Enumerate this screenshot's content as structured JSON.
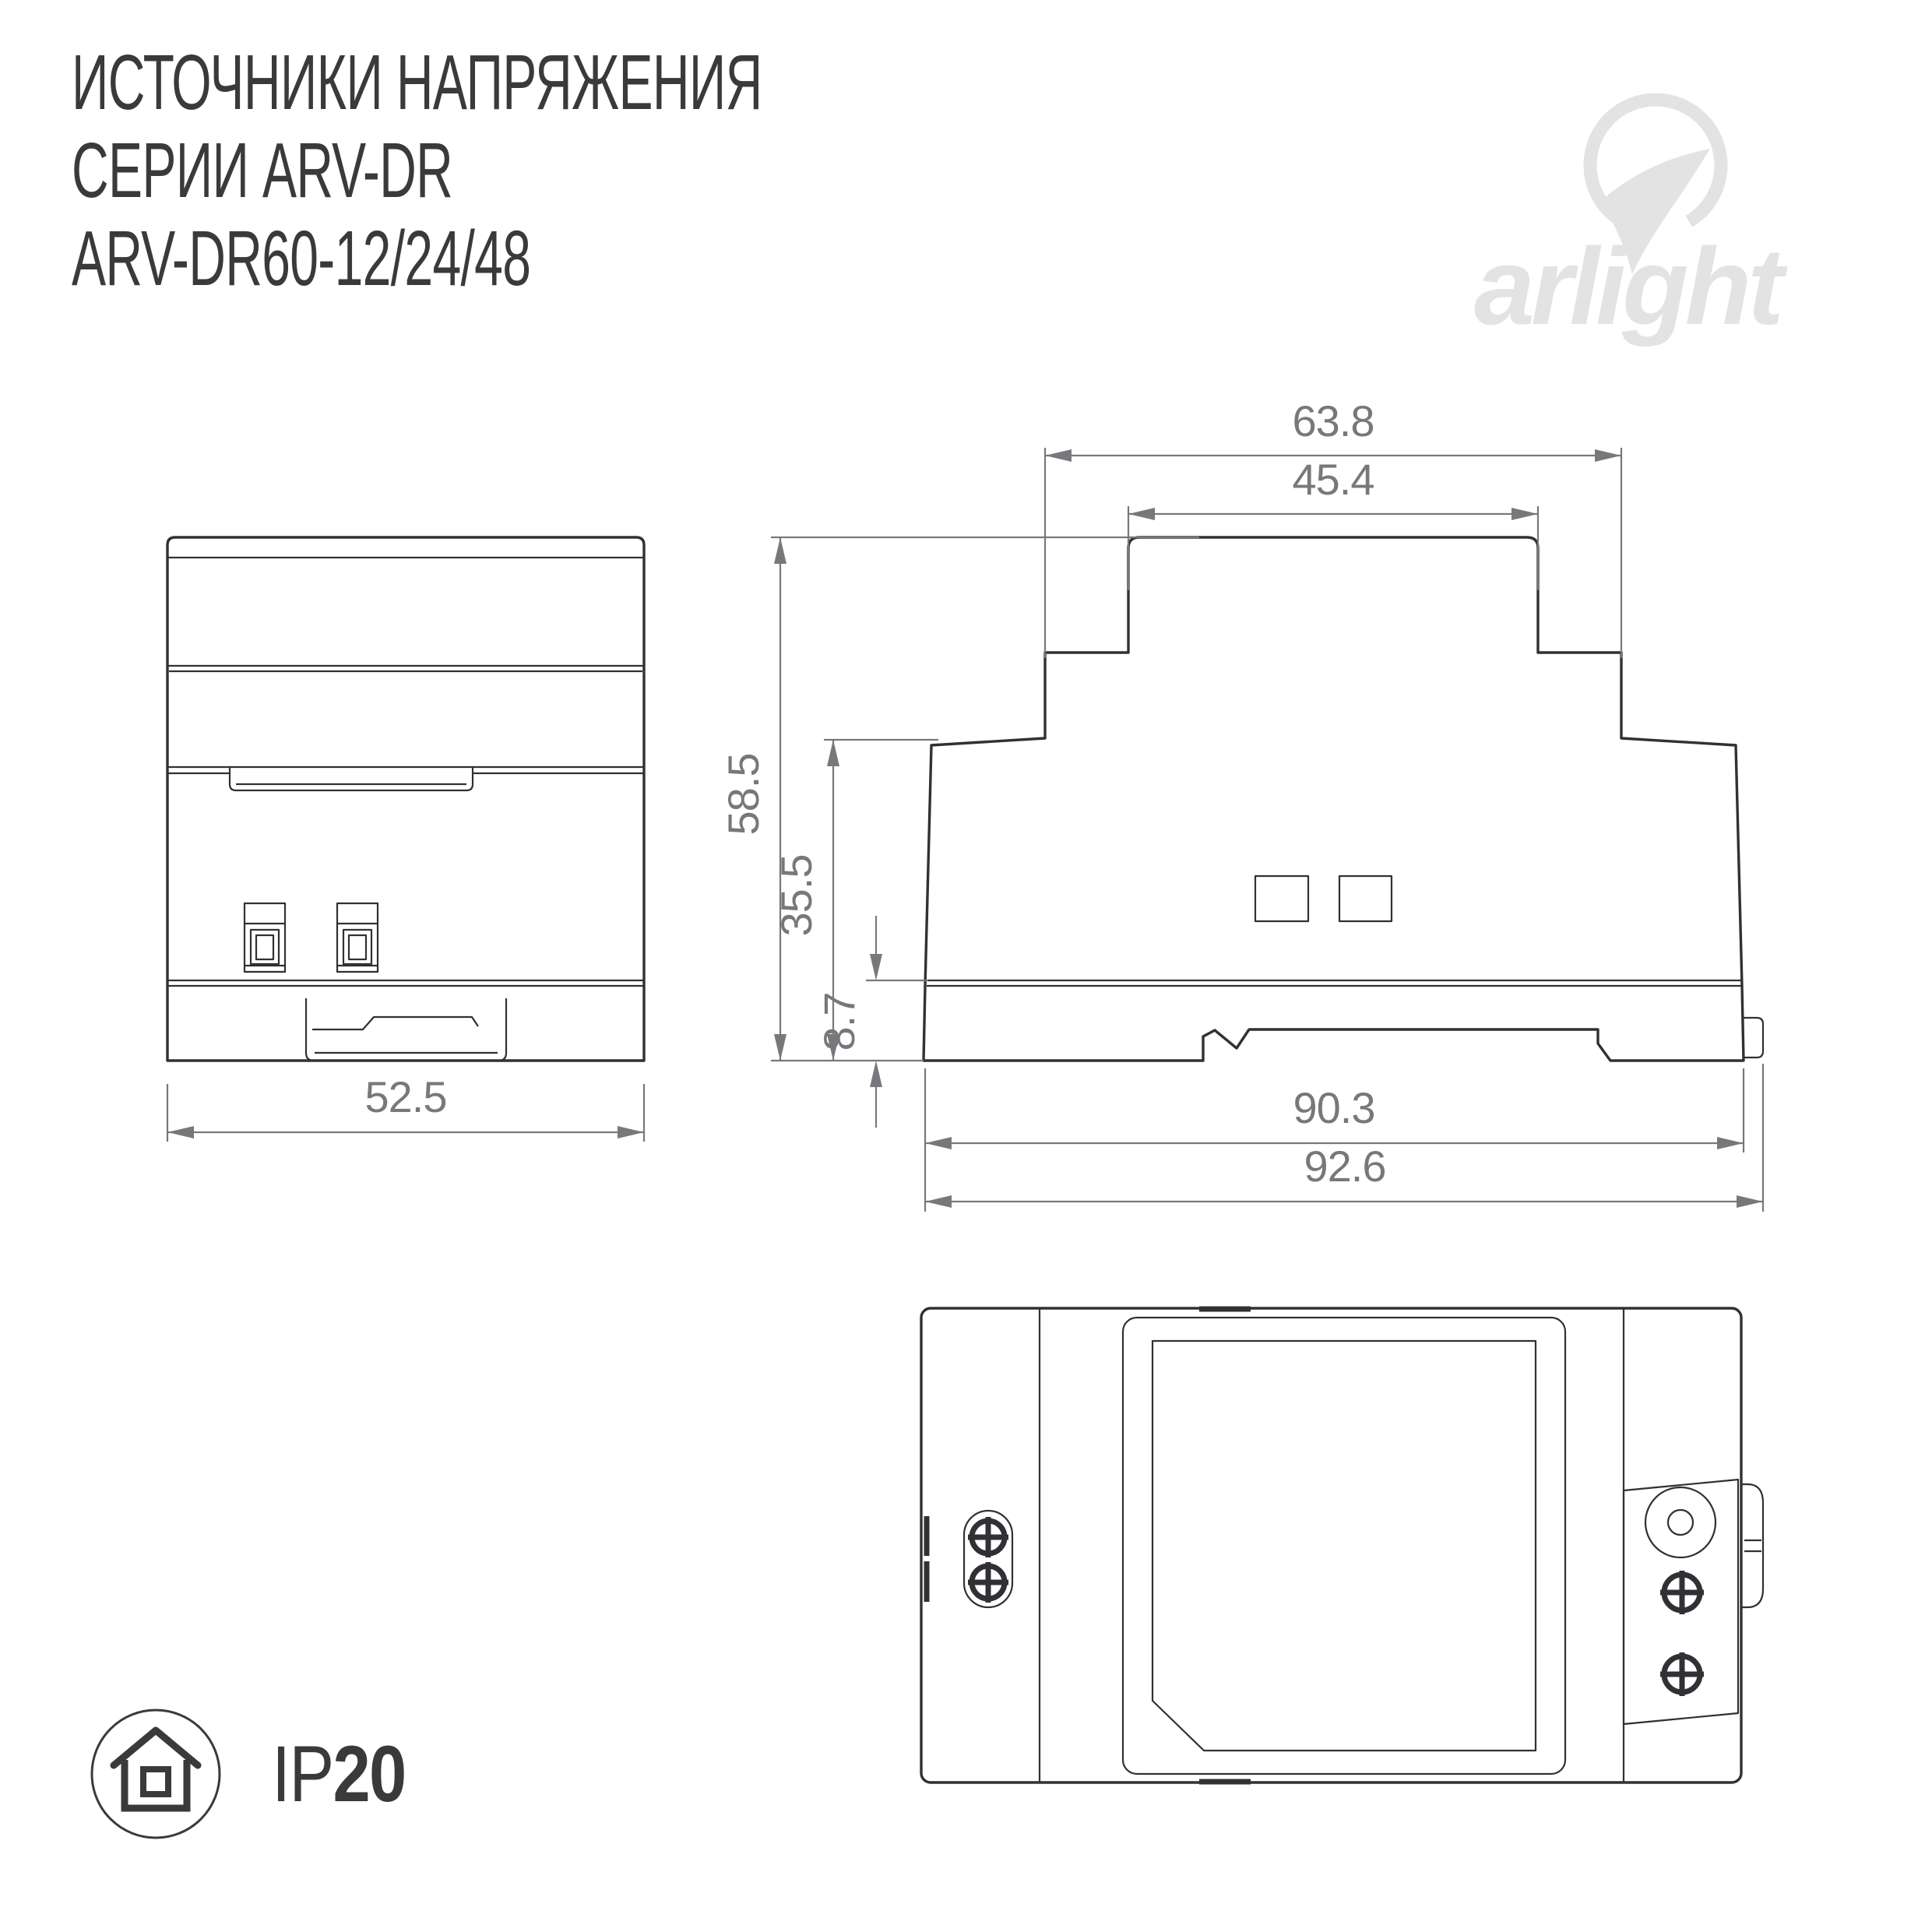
{
  "title": {
    "line1": "ИСТОЧНИКИ НАПРЯЖЕНИЯ",
    "line2": "СЕРИИ ARV-DR",
    "line3": "ARV-DR60-12/24/48"
  },
  "logo": {
    "text": "arlight",
    "color": "#e3e3e4"
  },
  "ip_badge": {
    "prefix": "IP",
    "value": "20"
  },
  "drawing": {
    "line_color": "#2f3134",
    "dim_color": "#77787b",
    "background": "#ffffff",
    "units": "mm",
    "dims": {
      "front_width": "52.5",
      "step_width": "63.8",
      "top_width": "45.4",
      "height": "58.5",
      "body_height": "35.5",
      "base_height": "8.7",
      "body_length": "90.3",
      "overall_length": "92.6"
    }
  }
}
